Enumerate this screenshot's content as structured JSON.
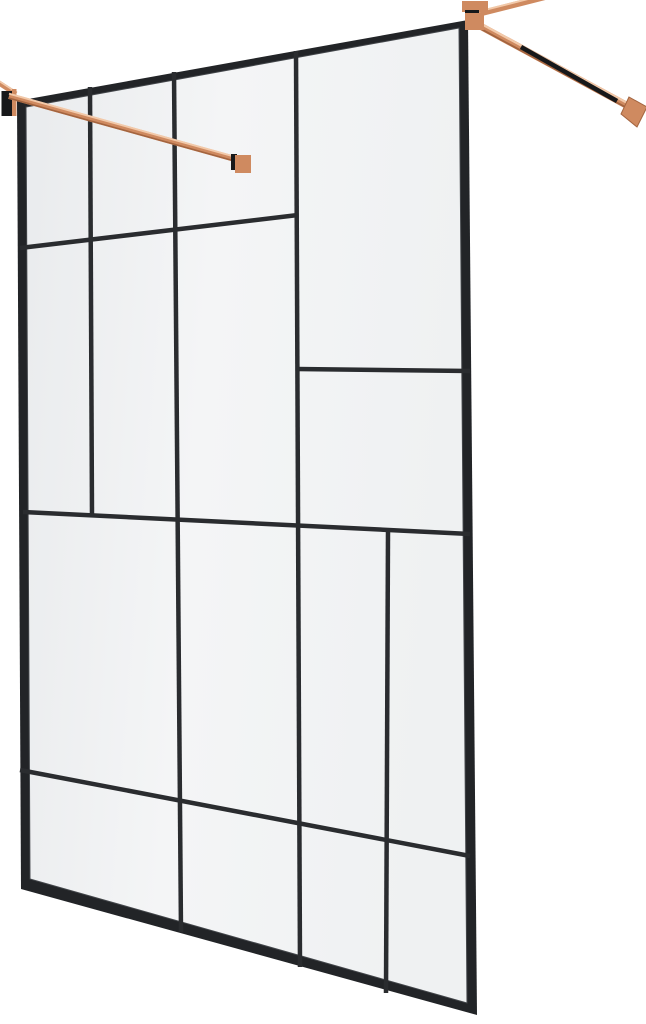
{
  "scene": {
    "description": "walk-in-shower-glass-screen-black-pattern-rose-gold-hardware",
    "width": 646,
    "height": 1024,
    "background": "#ffffff",
    "colors": {
      "frame": "#222427",
      "mullion": "#2a2c2f",
      "frame_bevel": "#43464a",
      "glass_light": "#f4f5f6",
      "glass_mid": "#eff1f2",
      "glass_dark": "#e9ebed",
      "copper": "#cf8a60",
      "copper_light": "#f2c9a9",
      "copper_dark": "#a3643f",
      "hardware_shadow": "#17181a"
    },
    "panel": {
      "outer_quad": [
        [
          17,
          101
        ],
        [
          468,
          20
        ],
        [
          477,
          1015
        ],
        [
          21,
          889
        ]
      ],
      "inner_quad": [
        [
          26,
          107
        ],
        [
          459,
          28
        ],
        [
          467,
          1003
        ],
        [
          30,
          879
        ]
      ],
      "mullion_width": 4.5,
      "mullions": [
        {
          "id": "v1",
          "from": [
            90,
            87
          ],
          "to": [
            92,
            516
          ]
        },
        {
          "id": "v2",
          "from": [
            174,
            72
          ],
          "to": [
            181,
            932
          ]
        },
        {
          "id": "v3",
          "from": [
            296,
            51
          ],
          "to": [
            300,
            967
          ]
        },
        {
          "id": "v4",
          "from": [
            388,
            531
          ],
          "to": [
            386,
            993
          ]
        },
        {
          "id": "h1",
          "from": [
            20,
            248
          ],
          "to": [
            298,
            215
          ]
        },
        {
          "id": "h2",
          "from": [
            297,
            369
          ],
          "to": [
            470,
            371
          ]
        },
        {
          "id": "h3",
          "from": [
            23,
            512
          ],
          "to": [
            470,
            534
          ]
        },
        {
          "id": "h4",
          "from": [
            20,
            770
          ],
          "to": [
            470,
            856
          ]
        }
      ]
    },
    "hardware": {
      "left": {
        "stub": {
          "from": [
            -4,
            81
          ],
          "to": [
            16,
            94
          ],
          "width": 5
        },
        "wall_plate": {
          "x": 1.5,
          "y": 91,
          "w": 13,
          "h": 25
        },
        "wall_plate_trim": {
          "x": 12,
          "y": 89,
          "w": 4.5,
          "h": 27
        },
        "arm": {
          "from": [
            9,
            96
          ],
          "to": [
            242,
            161
          ],
          "width": 6
        },
        "clamp_notch": {
          "x": 231,
          "y": 154,
          "w": 6,
          "h": 16
        },
        "clamp_block": {
          "x": 235,
          "y": 155,
          "w": 16,
          "h": 18
        }
      },
      "right": {
        "bar_upper": {
          "from": [
            466,
            17
          ],
          "to": [
            549,
            -4
          ],
          "width": 6
        },
        "arm": {
          "from": [
            471,
            21
          ],
          "to": [
            639,
            112
          ],
          "width": 7
        },
        "arm_reflection": {
          "from": [
            521,
            47
          ],
          "to": [
            617,
            101
          ],
          "width": 4.5
        },
        "clamp_top": {
          "x": 462,
          "y": 1,
          "w": 26,
          "h": 11
        },
        "clamp_notch": {
          "x": 465,
          "y": 10,
          "w": 14,
          "h": 5
        },
        "clamp_block": {
          "x": 465,
          "y": 13,
          "w": 19,
          "h": 17
        },
        "foot": [
          [
            629,
            97
          ],
          [
            647,
            107
          ],
          [
            637,
            127
          ],
          [
            621,
            114
          ]
        ]
      }
    }
  }
}
